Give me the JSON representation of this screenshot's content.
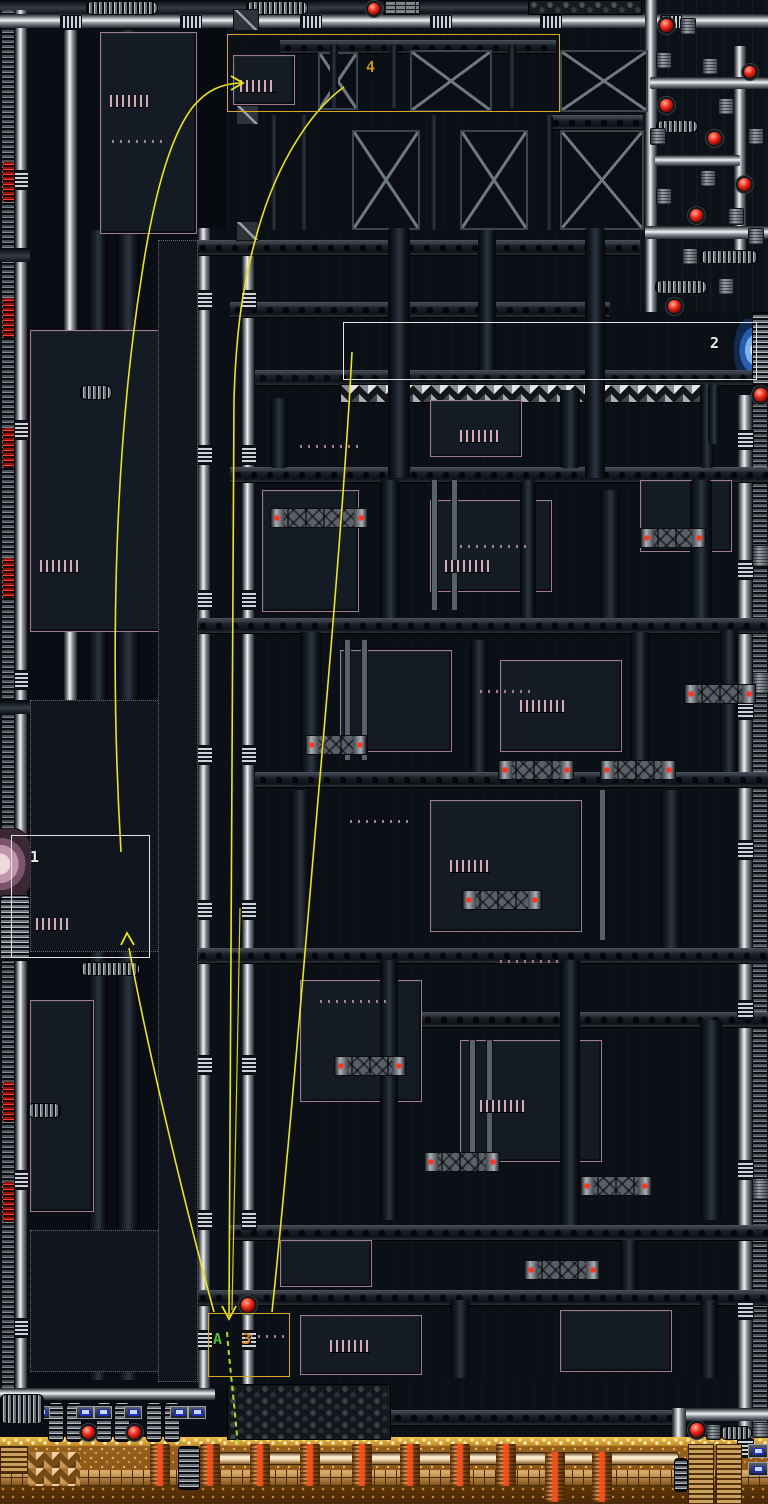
{
  "scene": {
    "kind": "game-level-map",
    "description": "Dark industrial 16-bit platformer level map with annotated route overlay"
  },
  "markers": {
    "zone1": {
      "label": "1",
      "outline": "#e4e4e4",
      "text_color": "#ececec"
    },
    "zone2": {
      "label": "2",
      "outline": "#e4e4e4",
      "text_color": "#ececec"
    },
    "zone3": {
      "label": "3",
      "outline": "#d8a820",
      "text_color": "#e08818"
    },
    "zone4": {
      "label": "4",
      "outline": "#d8a820",
      "text_color": "#cc9818"
    },
    "pointA": {
      "label": "A",
      "text_color": "#55c030"
    }
  },
  "route": {
    "primary_color": "#ece51c",
    "secret_color": "#a6e41e",
    "secret_style": "dashed",
    "arrows": [
      {
        "at": "zone4",
        "direction": "right"
      },
      {
        "at": "zone1",
        "direction": "up"
      },
      {
        "at": "zone3",
        "direction": "down"
      }
    ]
  },
  "palette": {
    "background": "#070a0f",
    "panel": "#151b24",
    "panel_outline_pink": "#d0a0b0",
    "pipe_highlight": "#f2f4f5",
    "alarm_red": "#f02818",
    "copper_zone": "#96601e",
    "gold_edge": "#f0c050",
    "door_pink": "#c096a8",
    "door_blue": "#7ab4f0",
    "indicator_blue": "#2030c0"
  }
}
